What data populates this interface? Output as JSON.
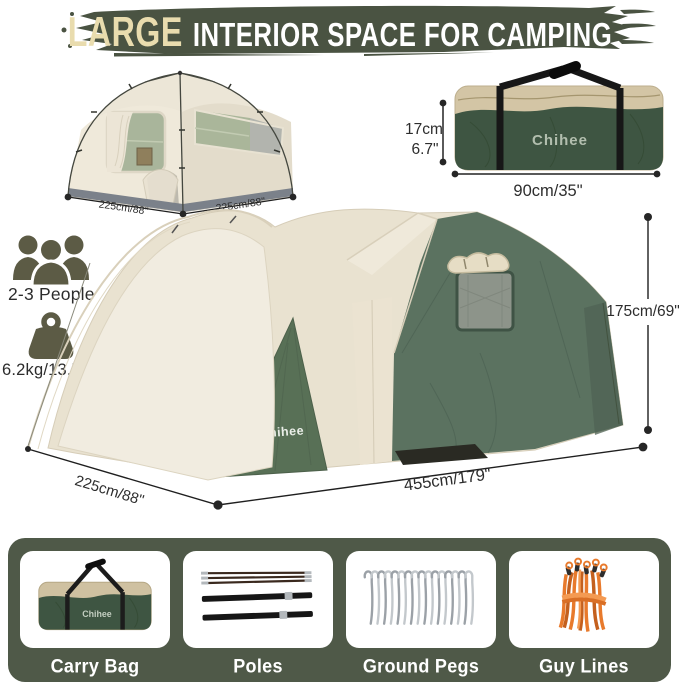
{
  "header": {
    "highlight": "LARGE",
    "rest": "INTERIOR SPACE FOR CAMPING"
  },
  "small_tent": {
    "dim_left": "225cm/88\"",
    "dim_right": "225cm/88\""
  },
  "carry_bag": {
    "brand": "Chihee",
    "height_cm": "17cm",
    "height_in": "6.7\"",
    "width": "90cm/35\""
  },
  "specs": {
    "capacity": "2-3 People",
    "weight": "6.2kg/13.7lbs"
  },
  "main_tent": {
    "brand": "Chihee",
    "height": "175cm/69\"",
    "depth": "225cm/88\"",
    "width": "455cm/179\""
  },
  "kit": {
    "bag_brand": "Chihee",
    "items": [
      {
        "label": "Carry Bag"
      },
      {
        "label": "Poles"
      },
      {
        "label": "Ground Pegs"
      },
      {
        "label": "Guy Lines"
      }
    ]
  },
  "colors": {
    "header_bg": "#4a5342",
    "header_highlight": "#e9dcae",
    "panel_bg": "#4f5948",
    "tent_green": "#5b7260",
    "tent_cream": "#ece6d5",
    "bag_green": "#3e5542",
    "bag_top": "#d3c5a5",
    "icon_olive": "#5c5b45",
    "rope_orange": "#e87a2c",
    "dimension_text": "#2d2d2d"
  }
}
